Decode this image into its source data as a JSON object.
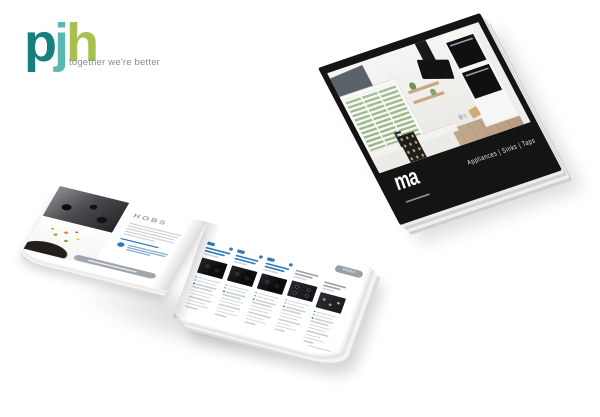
{
  "brand": {
    "letters": [
      {
        "char": "p",
        "color": "#15807c"
      },
      {
        "char": "j",
        "color": "#5bb7b1"
      },
      {
        "char": "h",
        "color": "#a6c150"
      }
    ],
    "tagline": "together we're better",
    "tagline_color": "#8c8c8c"
  },
  "closed_catalog": {
    "cover_logo_fragment": "ma",
    "side_text": "Appliances  |  Sinks  |  Taps",
    "cover_color": "#141414"
  },
  "open_catalog": {
    "left_page_heading": "HOBS",
    "right_page_tab": "Hobs"
  },
  "colors": {
    "accent_blue": "#2e79b8",
    "pill_gray": "#9aa1a7",
    "cover_black": "#141414"
  }
}
